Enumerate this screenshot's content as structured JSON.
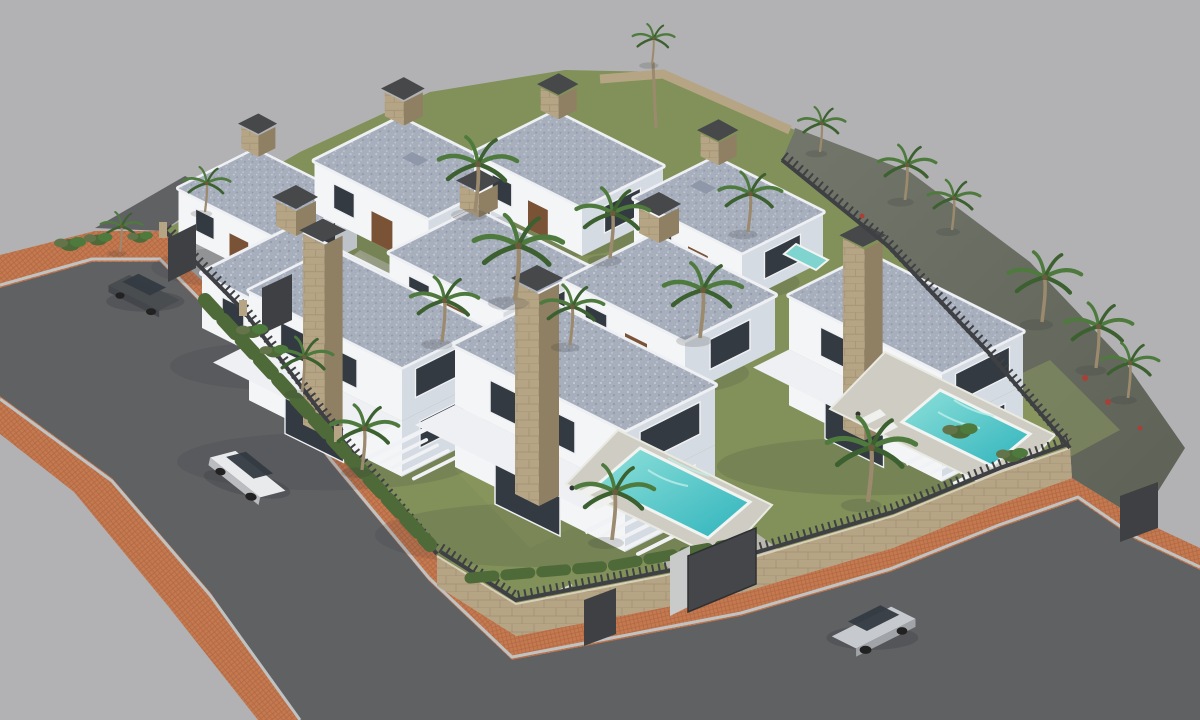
{
  "scene": {
    "type": "architectural-3d-render",
    "description": "Aerial 3D architect's rendering of a new-build residential development: nine modern two-storey white villas with flat gravel roofs, stone chimney columns and dark glazing, set in walled gardens with palm trees, hedges and three turquoise swimming pools; terracotta-paved sidewalks edge two asphalt roads with three cars, all on a plain grey background",
    "background_color": "#b2b2b4",
    "buildings": {
      "count": 9,
      "style": "modern white villas, flat speckled-gravel roofs with white parapets, natural-stone chimney columns with dark caps, dark window strips, wood-brown doors, white terrace slabs and pergolas"
    },
    "pools": {
      "count": 3,
      "water_color": "#2fb4bc",
      "deck_color": "#cfcdc3"
    },
    "cars": [
      {
        "name": "dark-suv",
        "color": "#4a4d50",
        "location": "driveway at upper-left entrance"
      },
      {
        "name": "white-suv",
        "color": "#e8eaec",
        "location": "left road"
      },
      {
        "name": "silver-suv",
        "color": "#c6c9cd",
        "location": "bottom road"
      }
    ],
    "roads": {
      "surface": "#5f6163",
      "sidewalk_pavers": "#c5794f",
      "curb": "#c0c3c3"
    },
    "site": {
      "perimeter": "natural-stone retaining walls with dark metal picket fencing and gates",
      "embankment": "dark earth bank along upper-right boundary",
      "vegetation": {
        "palm_trees": 20,
        "hedges": true,
        "grass_color": "#82915a",
        "accent_plants": "red flowering shrubs"
      }
    },
    "palette": {
      "bg": "#b2b2b4",
      "asphalt": "#5f6163",
      "curb": "#c0c3c3",
      "brick": "#c5794f",
      "brick-line": "#9e5b3c",
      "stone": "#b6a585",
      "stone-dark": "#8f7f63",
      "wall-white": "#f4f5f7",
      "wall-shadow": "#d5dbe2",
      "roof": "#a7aebc",
      "roof-light": "#c2c8d4",
      "roof-dark": "#8f98a8",
      "parapet": "#eef0f4",
      "glass": "#343a41",
      "wood": "#7a5236",
      "fence": "#3e4043",
      "cap": "#46484a",
      "grass": "#82915a",
      "grass-dark": "#64744a",
      "hedge": "#4f6a39",
      "palm": "#4e7a3e",
      "palm-dark": "#3c6030",
      "trunk": "#9b8a6d",
      "pool-deep": "#2fb4bc",
      "pool-light": "#8fe0da",
      "deck": "#cfcdc3",
      "bank": "#5d6156",
      "bank-light": "#73766a",
      "car-white": "#e8eaec",
      "car-silver": "#c6c9cd",
      "car-dark": "#4a4d50"
    }
  }
}
